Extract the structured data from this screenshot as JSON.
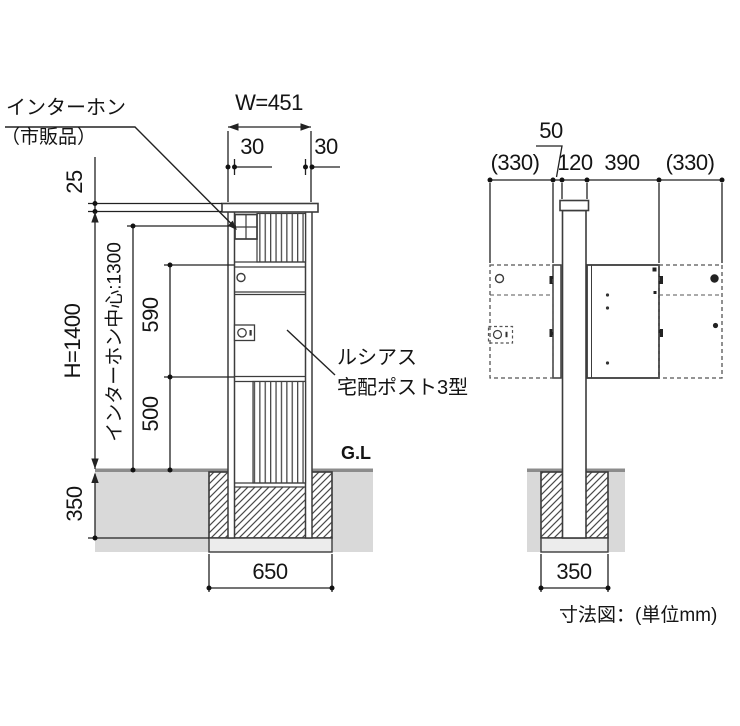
{
  "note": "寸法図：(単位mm)",
  "callouts": {
    "intercom": {
      "line1": "インターホン",
      "line2": "（市販品）"
    },
    "product": {
      "line1": "ルシアス",
      "line2": "宅配ポスト3型"
    },
    "ground_level": "G.L"
  },
  "front_view": {
    "dims": {
      "width": "W=451",
      "left_frame": "30",
      "right_frame": "30",
      "cap": "25",
      "height": "H=1400",
      "intercom_center": "インターホン中心:1300",
      "box_height": "590",
      "below_box": "500",
      "embed_depth": "350",
      "footing_width": "650"
    }
  },
  "side_view": {
    "dims": {
      "front_swing": "(330)",
      "front_gap": "50",
      "post": "120",
      "depth": "390",
      "rear_swing": "(330)",
      "footing_width": "350"
    }
  }
}
